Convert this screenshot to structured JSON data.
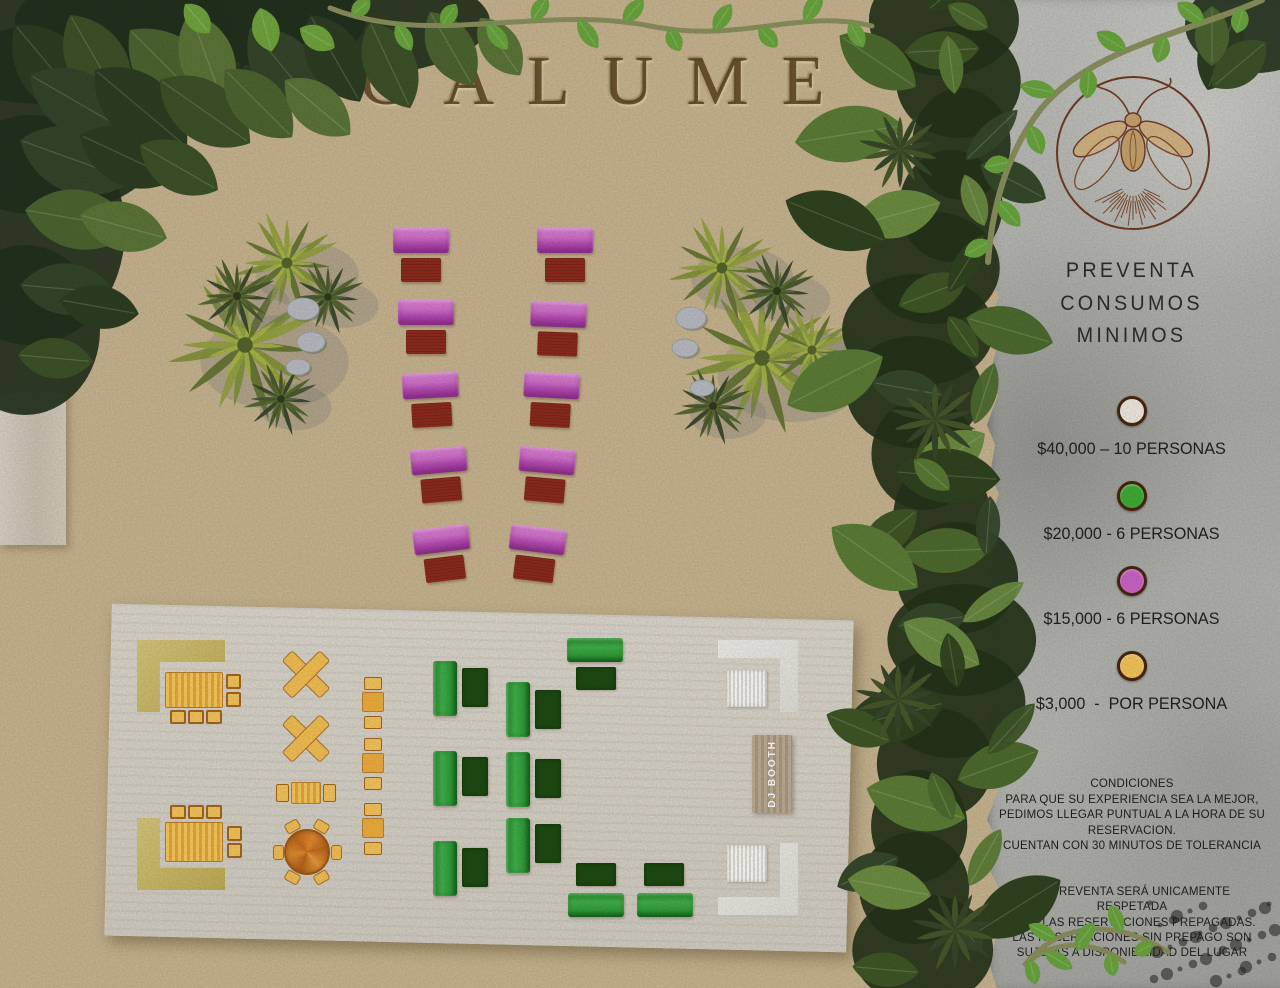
{
  "title": "VAGALUME",
  "panel": {
    "heading": "PREVENTA\nCONSUMOS\nMINIMOS",
    "legend": [
      {
        "color": "#efe9e1",
        "label": "$40,000 – 10 PERSONAS"
      },
      {
        "color": "#41ab36",
        "label": "$20,000 - 6 PERSONAS"
      },
      {
        "color": "#ca63c8",
        "label": "$15,000 - 6 PERSONAS"
      },
      {
        "color": "#f3c55b",
        "label": "$3,000  -  POR PERSONA"
      }
    ],
    "conditions_block1": "CONDICIONES\nPARA QUE SU EXPERIENCIA SEA LA MEJOR,\nPEDIMOS LLEGAR PUNTUAL A LA HORA DE SU\nRESERVACION.\nCUENTAN CON 30 MINUTOS DE TOLERANCIA",
    "conditions_block2": "LA PREVENTA SERÁ UNICAMENTE RESPETADA\nPARA LAS RESERVACIONES PREPAGADAS.\nLAS RESERVACIONES SIN PREPAGO SON\nSUJETAS A DISPONIBILIDAD DEL LUGAR"
  },
  "map": {
    "dj_booth_label": "DJ BOOTH",
    "colors": {
      "sand": "#c7b491",
      "stone_panel": "#b2b3b1",
      "deck": "#d7d3ca",
      "purple_sofa": "#c75fc4",
      "red_table": "#8e2b1d",
      "green_sofa": "#35a33f",
      "dark_green_table": "#1d4a12",
      "yellow_furniture": "#f2bf55",
      "olive_lounge": "#c9b55e",
      "white_lounge": "#e7e7e4",
      "logo_brown": "#6e3a26"
    }
  }
}
